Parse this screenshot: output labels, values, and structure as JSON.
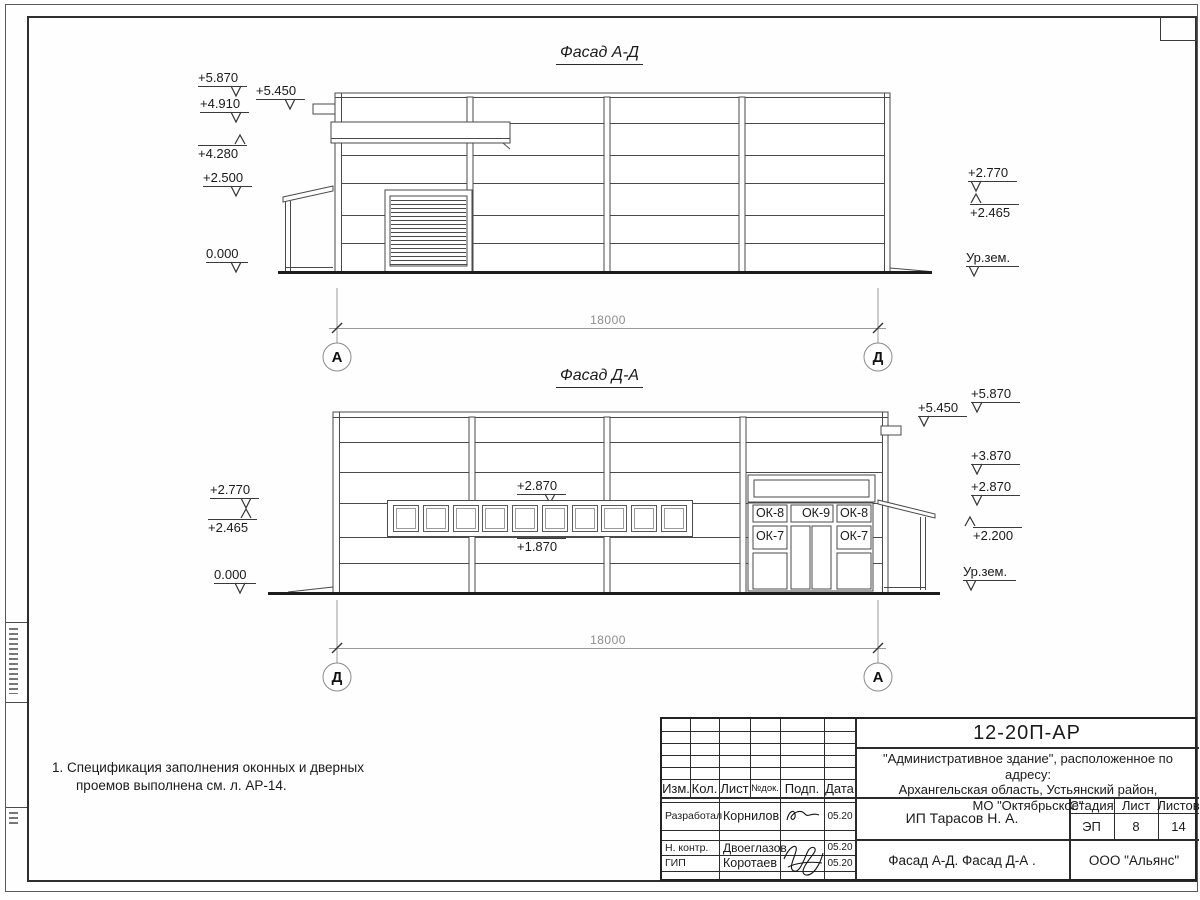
{
  "facade1": {
    "title": "Фасад А-Д",
    "marks_left": [
      "+5.870",
      "+5.450",
      "+4.910",
      "+4.280",
      "+2.500",
      "0.000"
    ],
    "marks_right": [
      "+2.770",
      "+2.465",
      "Ур.зем."
    ],
    "dimension": "18000",
    "axis_left": "А",
    "axis_right": "Д"
  },
  "facade2": {
    "title": "Фасад Д-А",
    "marks_left": [
      "+2.770",
      "+2.465",
      "0.000"
    ],
    "marks_right": [
      "+5.870",
      "+5.450",
      "+3.870",
      "+2.870",
      "+2.200",
      "Ур.зем."
    ],
    "window_marks": [
      "+2.870",
      "+1.870"
    ],
    "window_labels": [
      "ОК-8",
      "ОК-9",
      "ОК-8",
      "ОК-7",
      "ОК-7"
    ],
    "dimension": "18000",
    "axis_left": "Д",
    "axis_right": "А"
  },
  "note": {
    "line1": "1. Спецификация заполнения оконных и дверных",
    "line2": "проемов выполнена см. л. АР-14."
  },
  "titleblock": {
    "doc_code": "12-20П-АР",
    "project_line1": "\"Административное здание\", расположенное по адресу:",
    "project_line2": "Архангельская область, Устьянский район,",
    "project_line3": "МО \"Октябрьское\"",
    "client": "ИП Тарасов Н. А.",
    "sheet_title": "Фасад А-Д. Фасад Д-А .",
    "company": "ООО \"Альянс\"",
    "header": {
      "izm": "Изм.",
      "kol": "Кол.",
      "list": "Лист",
      "ndok": "№док.",
      "podp": "Подп.",
      "data": "Дата"
    },
    "stage_label": "Стадия",
    "sheet_label": "Лист",
    "sheets_label": "Листов",
    "stage": "ЭП",
    "sheet_no": "8",
    "sheets_total": "14",
    "rows": [
      {
        "role": "Разработал",
        "name": "Корнилов",
        "date": "05.20"
      },
      {
        "role": "Н. контр.",
        "name": "Двоеглазов",
        "date": "05.20"
      },
      {
        "role": "ГИП",
        "name": "Коротаев",
        "date": "05.20"
      }
    ]
  }
}
